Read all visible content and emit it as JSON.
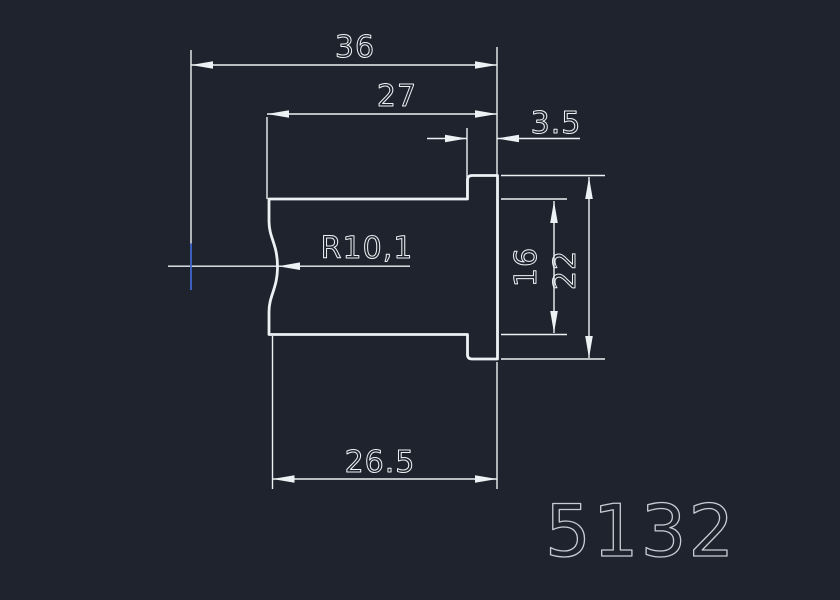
{
  "drawing": {
    "colors": {
      "background": "#1e232e",
      "line": "#eef1f4",
      "accent_blue": "#4066cf",
      "part_number_gray": "#c7ccd3"
    },
    "dimensions": {
      "total_width": "36",
      "body_width": "27",
      "flange_width": "3.5",
      "left_face_radius": "R10,1",
      "body_height": "16",
      "flange_height": "22",
      "bottom_width": "26.5"
    },
    "part_number": "5132"
  }
}
